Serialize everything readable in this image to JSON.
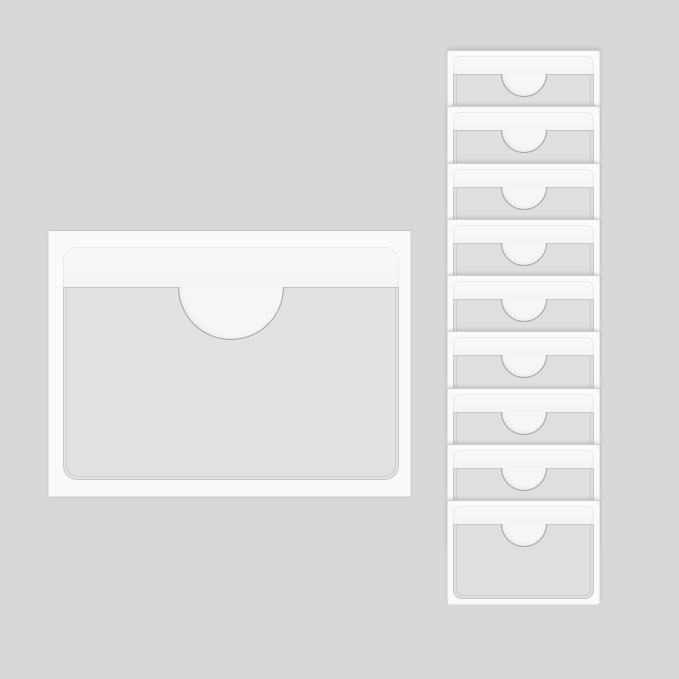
{
  "product": {
    "name": "self-adhesive-index-card-pockets",
    "description": "Clear self-adhesive card pocket sleeves with a half-moon thumb notch: one large pocket shown at left, and a vertical overlapping stack of nine small pockets at right, on a plain gray backdrop",
    "large_pocket_count": 1,
    "stack_pocket_count": 9
  },
  "stack": {
    "overlap_pitch_px": 56.25
  },
  "colors": {
    "background": "#DAD7D7",
    "backing_sheet": "#FBFAFA",
    "adhesive_band": "#F5F4F4",
    "pocket_front": "#E3E2E2",
    "stack_pocket_front": "#E0DFDF",
    "notch_fill": "#F7F6F6",
    "notch_outline": "#A2A2A2",
    "pocket_edge": "#C7C5C5"
  }
}
